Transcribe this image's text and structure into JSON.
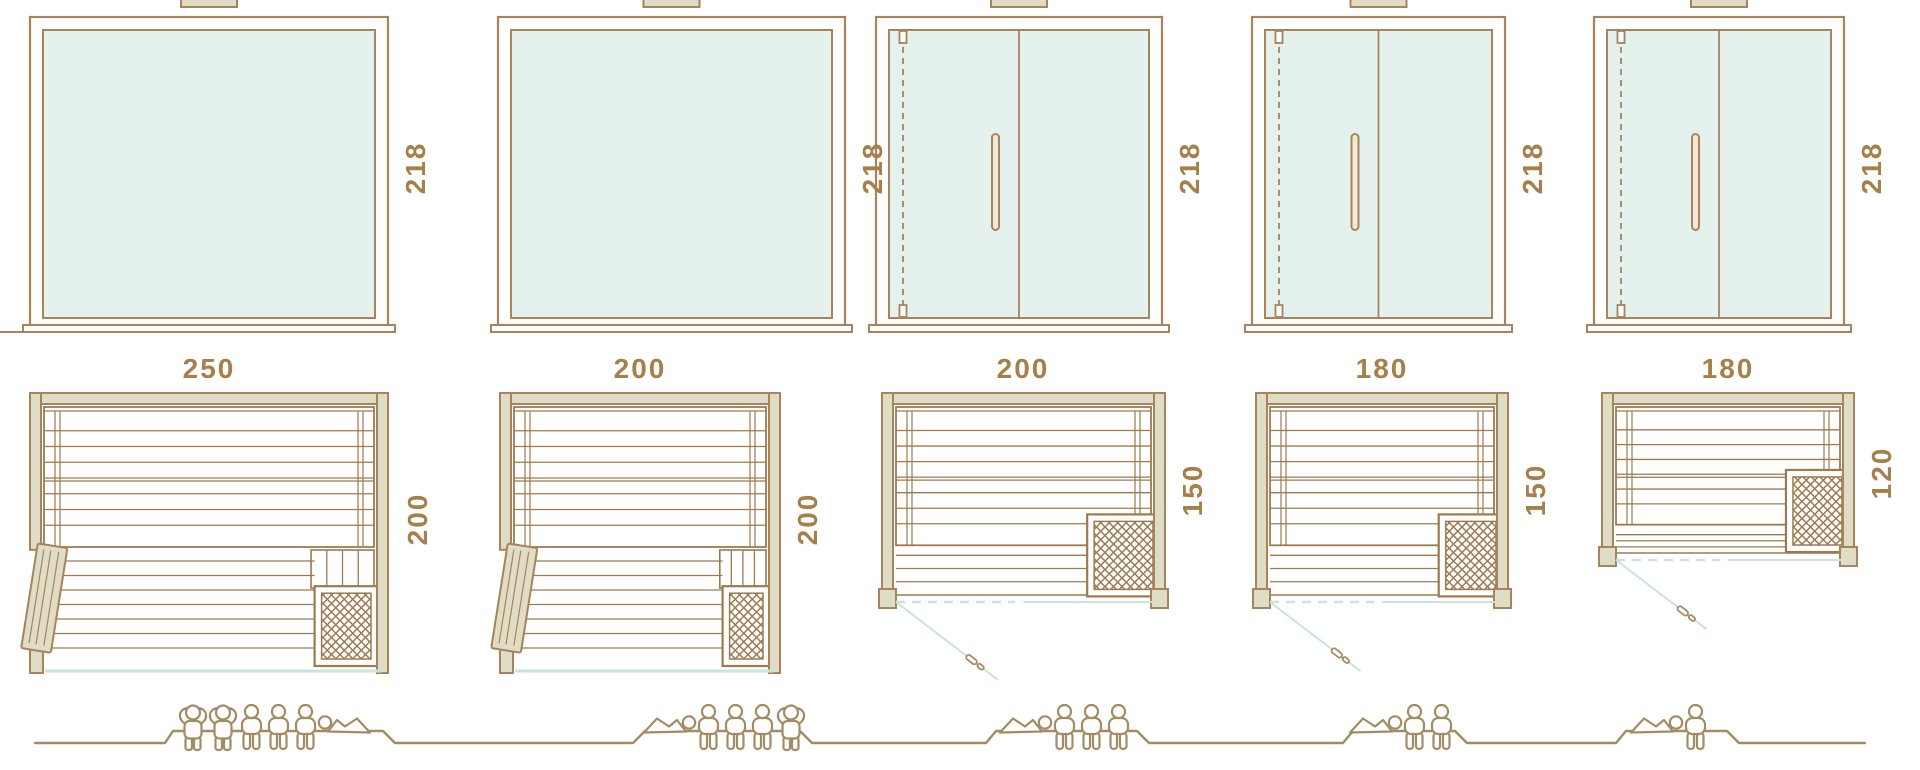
{
  "diagram_title": "sauna-size-comparison",
  "colors": {
    "frame_brown": "#a8835b",
    "plan_brown": "#9c7a4e",
    "wall_fill": "#dfddc5",
    "glass_fill": "#e4f1ed",
    "teal_accent": "#c9e4de",
    "label_text": "#a5804a",
    "people_brown": "#a38c62",
    "handle_fill": "#f0e9da",
    "background": "#ffffff"
  },
  "models": [
    {
      "name": "sauna-250x200",
      "width_cm": "250",
      "height_cm": "218",
      "depth_cm": "200",
      "front": "fixed-glass",
      "plan_style": "open-hinged-door",
      "capacity": {
        "standing": 2,
        "sitting": 3,
        "lying": 1,
        "figures": [
          "standing",
          "standing",
          "sitting",
          "sitting",
          "sitting",
          "lying"
        ]
      }
    },
    {
      "name": "sauna-200x200",
      "width_cm": "200",
      "height_cm": "218",
      "depth_cm": "200",
      "front": "fixed-glass",
      "plan_style": "open-hinged-door",
      "capacity": {
        "standing": 1,
        "sitting": 3,
        "lying": 1,
        "figures": [
          "lying",
          "sitting",
          "sitting",
          "sitting",
          "standing"
        ]
      }
    },
    {
      "name": "sauna-200x150",
      "width_cm": "200",
      "height_cm": "218",
      "depth_cm": "150",
      "front": "glass-door",
      "plan_style": "swing-door",
      "capacity": {
        "standing": 0,
        "sitting": 3,
        "lying": 1,
        "figures": [
          "lying",
          "sitting",
          "sitting",
          "sitting"
        ]
      }
    },
    {
      "name": "sauna-180x150",
      "width_cm": "180",
      "height_cm": "218",
      "depth_cm": "150",
      "front": "glass-door",
      "plan_style": "swing-door",
      "capacity": {
        "standing": 0,
        "sitting": 2,
        "lying": 1,
        "figures": [
          "lying",
          "sitting",
          "sitting"
        ]
      }
    },
    {
      "name": "sauna-180x120",
      "width_cm": "180",
      "height_cm": "218",
      "depth_cm": "120",
      "front": "glass-door",
      "plan_style": "swing-door",
      "capacity": {
        "standing": 0,
        "sitting": 1,
        "lying": 1,
        "figures": [
          "lying",
          "sitting"
        ]
      }
    }
  ]
}
